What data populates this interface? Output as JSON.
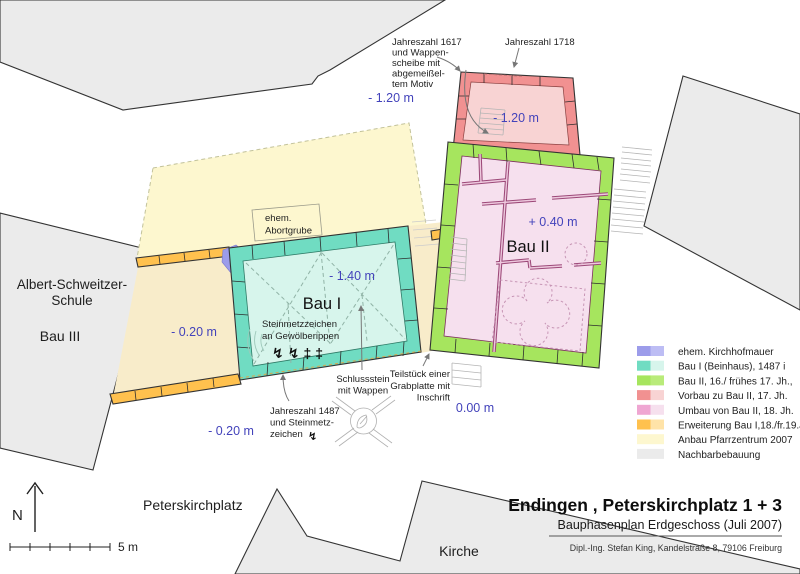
{
  "title_block": {
    "title": "Endingen , Peterskirchplatz 1 + 3",
    "subtitle": "Bauphasenplan Erdgeschoss (Juli 2007)",
    "credit": "Dipl.-Ing. Stefan King, Kandelstraße 8, 79106 Freiburg"
  },
  "legend": {
    "items": [
      {
        "label": "ehem. Kirchhofmauer",
        "color": "#9c9cea",
        "light": "#bdbdf4"
      },
      {
        "label": "Bau I (Beinhaus), 1487 i",
        "color": "#70dcc2",
        "light": "#d7f5ec"
      },
      {
        "label": "Bau II, 16./ frühes 17. Jh.,",
        "color": "#a6e55e",
        "light": "#b9eb7a"
      },
      {
        "label": "Vorbau zu Bau II, 17. Jh.",
        "color": "#f19191",
        "light": "#f8d3d3"
      },
      {
        "label": "Umbau von Bau II, 18. Jh.",
        "color": "#efa6d2",
        "light": "#f6e0ee"
      },
      {
        "label": "Erweiterung Bau I,18./fr.19.Jh.",
        "color": "#ffc14e",
        "light": "#ffe3a8"
      },
      {
        "label": "Anbau Pfarrzentrum 2007",
        "color": "#fdf7cf",
        "light": "#fdf7cf"
      },
      {
        "label": "Nachbarbebauung",
        "color": "#ebebeb",
        "light": "#ebebeb"
      }
    ]
  },
  "colors": {
    "level_text": "#4343bb",
    "erweiterung_interior": "#f8ecca",
    "wall_outline": "#333333"
  },
  "map": {
    "labels": {
      "bau1": "Bau I",
      "bau2": "Bau II",
      "bau3": "Bau III",
      "school1": "Albert-Schweitzer-",
      "school2": "Schule",
      "church": "Kirche",
      "square": "Peterskirchplatz"
    },
    "levels": {
      "vorbau_west": "- 1.20 m",
      "vorbau": "- 1.20 m",
      "bau2": "+ 0.40 m",
      "bau1": "- 1.40 m",
      "erweiterung": "- 0.20 m",
      "erweiterung_south": "- 0.20 m",
      "courtyard": "0.00 m"
    },
    "annotations": {
      "jz1617": [
        "Jahreszahl 1617",
        "und Wappen-",
        "scheibe mit",
        "abgemeißel-",
        "tem Motiv"
      ],
      "jz1718": "Jahreszahl 1718",
      "abortgrube": [
        "ehem.",
        "Abortgrube"
      ],
      "steinmetz": [
        "Steinmetzzeichen",
        "an Gewölberippen"
      ],
      "steinmetz_marks": "↯↯‡‡",
      "jz1487": [
        "Jahreszahl 1487",
        "und Steinmetz-",
        "zeichen"
      ],
      "jz1487_mark": "↯",
      "schlussstein": [
        "Schlussstein",
        "mit Wappen"
      ],
      "grabplatte": [
        "Teilstück einer",
        "Grabplatte mit",
        "Inschrift"
      ]
    }
  },
  "compass": {
    "north": "N",
    "scale_label": "5 m"
  }
}
